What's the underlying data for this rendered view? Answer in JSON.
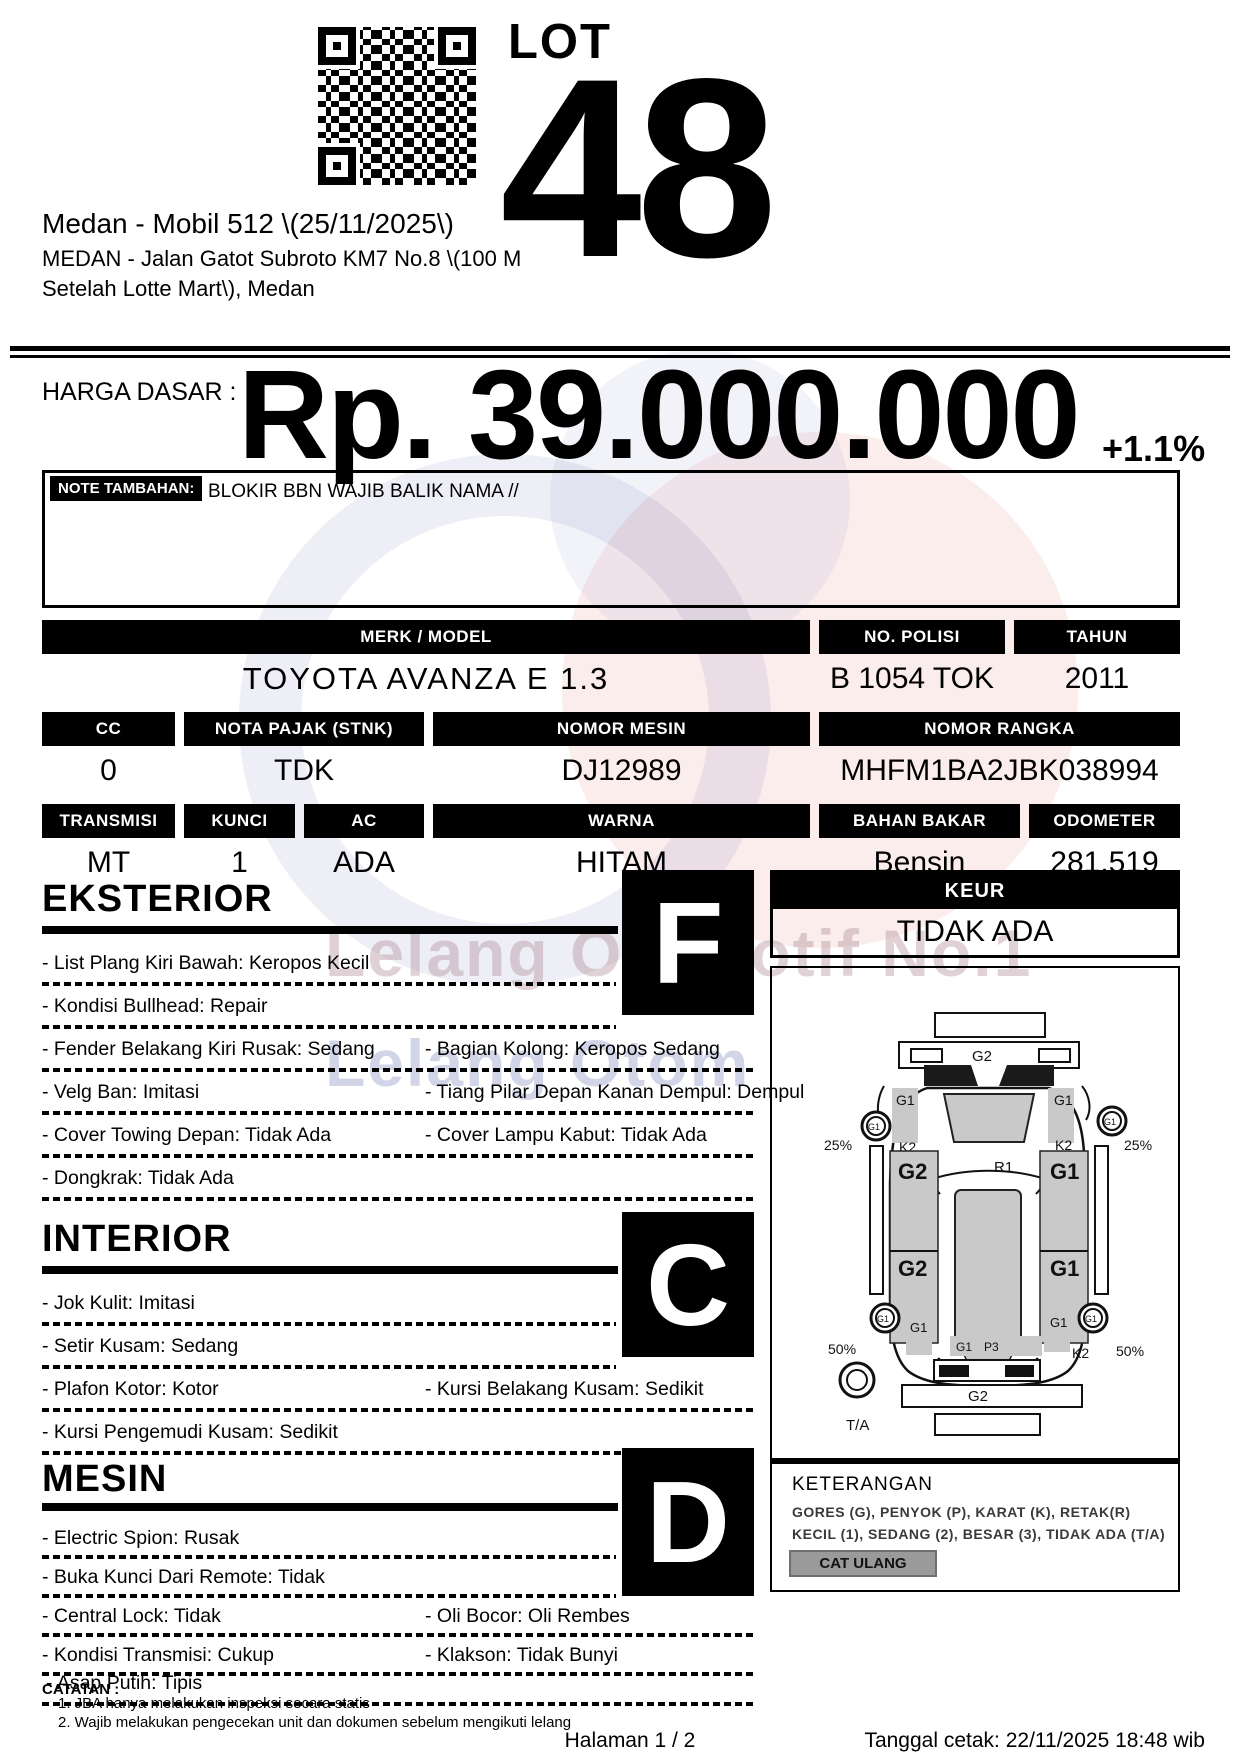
{
  "header": {
    "lot_label": "LOT",
    "lot_number": "48",
    "title": "Medan - Mobil 512 \\(25/11/2025\\)",
    "address_line1": "MEDAN - Jalan Gatot Subroto KM7 No.8 \\(100 M",
    "address_line2": "Setelah Lotte Mart\\), Medan"
  },
  "price": {
    "label": "HARGA DASAR :",
    "amount": "Rp. 39.000.000",
    "change": "+1.1%"
  },
  "note": {
    "label": "NOTE TAMBAHAN:",
    "content": "BLOKIR BBN WAJIB BALIK NAMA //"
  },
  "vehicle": {
    "merk_model": {
      "label": "MERK / MODEL",
      "value": "TOYOTA AVANZA E 1.3"
    },
    "no_polisi": {
      "label": "NO. POLISI",
      "value": "B 1054 TOK"
    },
    "tahun": {
      "label": "TAHUN",
      "value": "2011"
    },
    "cc": {
      "label": "CC",
      "value": "0"
    },
    "nota_pajak": {
      "label": "NOTA PAJAK (STNK)",
      "value": "TDK"
    },
    "nomor_mesin": {
      "label": "NOMOR MESIN",
      "value": "DJ12989"
    },
    "nomor_rangka": {
      "label": "NOMOR RANGKA",
      "value": "MHFM1BA2JBK038994"
    },
    "transmisi": {
      "label": "TRANSMISI",
      "value": "MT"
    },
    "kunci": {
      "label": "KUNCI",
      "value": "1"
    },
    "ac": {
      "label": "AC",
      "value": "ADA"
    },
    "warna": {
      "label": "WARNA",
      "value": "HITAM"
    },
    "bahan_bakar": {
      "label": "BAHAN BAKAR",
      "value": "Bensin"
    },
    "odometer": {
      "label": "ODOMETER",
      "value": "281.519"
    }
  },
  "sections": {
    "eksterior": {
      "title": "EKSTERIOR",
      "grade": "F",
      "rows": [
        {
          "left": "- List Plang Kiri Bawah: Keropos Kecil",
          "right": ""
        },
        {
          "left": "- Kondisi Bullhead: Repair",
          "right": ""
        },
        {
          "left": "- Fender Belakang Kiri Rusak: Sedang",
          "right": "- Bagian Kolong: Keropos Sedang"
        },
        {
          "left": "- Velg Ban: Imitasi",
          "right": "- Tiang Pilar Depan Kanan Dempul: Dempul"
        },
        {
          "left": "- Cover Towing Depan: Tidak Ada",
          "right": "- Cover Lampu Kabut: Tidak Ada"
        },
        {
          "left": "- Dongkrak: Tidak Ada",
          "right": ""
        }
      ]
    },
    "interior": {
      "title": "INTERIOR",
      "grade": "C",
      "rows": [
        {
          "left": "- Jok Kulit: Imitasi",
          "right": ""
        },
        {
          "left": "- Setir Kusam: Sedang",
          "right": ""
        },
        {
          "left": "- Plafon Kotor: Kotor",
          "right": "- Kursi Belakang Kusam: Sedikit"
        },
        {
          "left": "- Kursi Pengemudi Kusam: Sedikit",
          "right": ""
        }
      ]
    },
    "mesin": {
      "title": "MESIN",
      "grade": "D",
      "rows": [
        {
          "left": "- Electric Spion: Rusak",
          "right": ""
        },
        {
          "left": "- Buka Kunci Dari Remote: Tidak",
          "right": ""
        },
        {
          "left": "- Central Lock: Tidak",
          "right": "- Oli Bocor: Oli Rembes"
        },
        {
          "left": "- Kondisi Transmisi: Cukup",
          "right": "- Klakson: Tidak Bunyi"
        }
      ],
      "overlay_item": "- Asap Putih: Tipis"
    }
  },
  "keur": {
    "label": "KEUR",
    "value": "TIDAK ADA"
  },
  "diagram": {
    "top_panel": "G2",
    "left_fender": "G1",
    "right_fender": "G1",
    "left_mirror": "G1",
    "right_mirror": "G1",
    "left_a_pillar": "K2",
    "right_a_pillar": "K2",
    "front_left_tire": "25%",
    "front_right_tire": "25%",
    "front_left_door": "G2",
    "front_right_door": "G1",
    "roof": "R1",
    "rear_left_door": "G2",
    "rear_right_door": "G1",
    "rear_left_wheel": "G1",
    "rear_right_wheel": "G1",
    "rear_left_tire": "50%",
    "rear_right_tire": "50%",
    "rear_left_quarter": "G1",
    "rear_right_quarter": "G1",
    "tailgate_1": "G1",
    "tailgate_2": "P3",
    "rear_right_corner": "K2",
    "rear_bumper": "G2",
    "spare_tire": "T/A"
  },
  "keterangan": {
    "title": "KETERANGAN",
    "line1": "GORES (G), PENYOK (P), KARAT (K), RETAK(R)",
    "line2": "KECIL (1), SEDANG (2), BESAR (3), TIDAK ADA (T/A)",
    "button": "CAT ULANG"
  },
  "catatan": {
    "label": "CATATAN :",
    "line1": "1. JBA hanya melakukan inspeksi secara statis",
    "line2": "2. Wajib melakukan pengecekan unit dan dokumen sebelum mengikuti lelang"
  },
  "footer": {
    "page": "Halaman 1 / 2",
    "printed": "Tanggal cetak: 22/11/2025 18:48 wib"
  },
  "watermark": {
    "line1": "Lelang Otomotif No.1",
    "line2": "Lelang Otomotif"
  }
}
